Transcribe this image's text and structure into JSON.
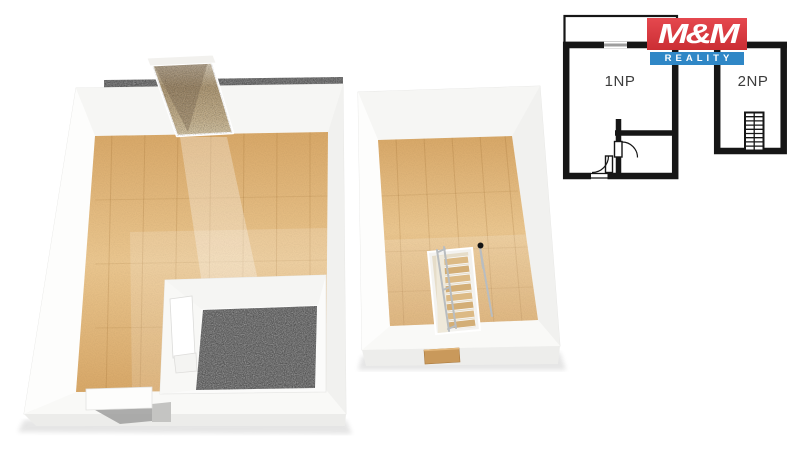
{
  "plan2d": {
    "unit1_label": "1NP",
    "unit2_label": "2NP",
    "wall_color": "#161616",
    "label_color": "#3c3c3c",
    "window_color": "#9d9d9d"
  },
  "logo": {
    "line1": "M&M",
    "line2": "REALITY",
    "red": "#e2333a",
    "blue": "#2f87c6",
    "text_color": "#ffffff"
  },
  "scene3d": {
    "wall_color": "#fbfbfa",
    "wood_light": "#eac68f",
    "wood_dark": "#d8a868",
    "terrazzo_color": "#6e6e6e",
    "ramp_color": "#a9936f",
    "railing_color": "#b9bdc0",
    "stair_wood": "#dcba85",
    "knob_color": "#141414"
  }
}
